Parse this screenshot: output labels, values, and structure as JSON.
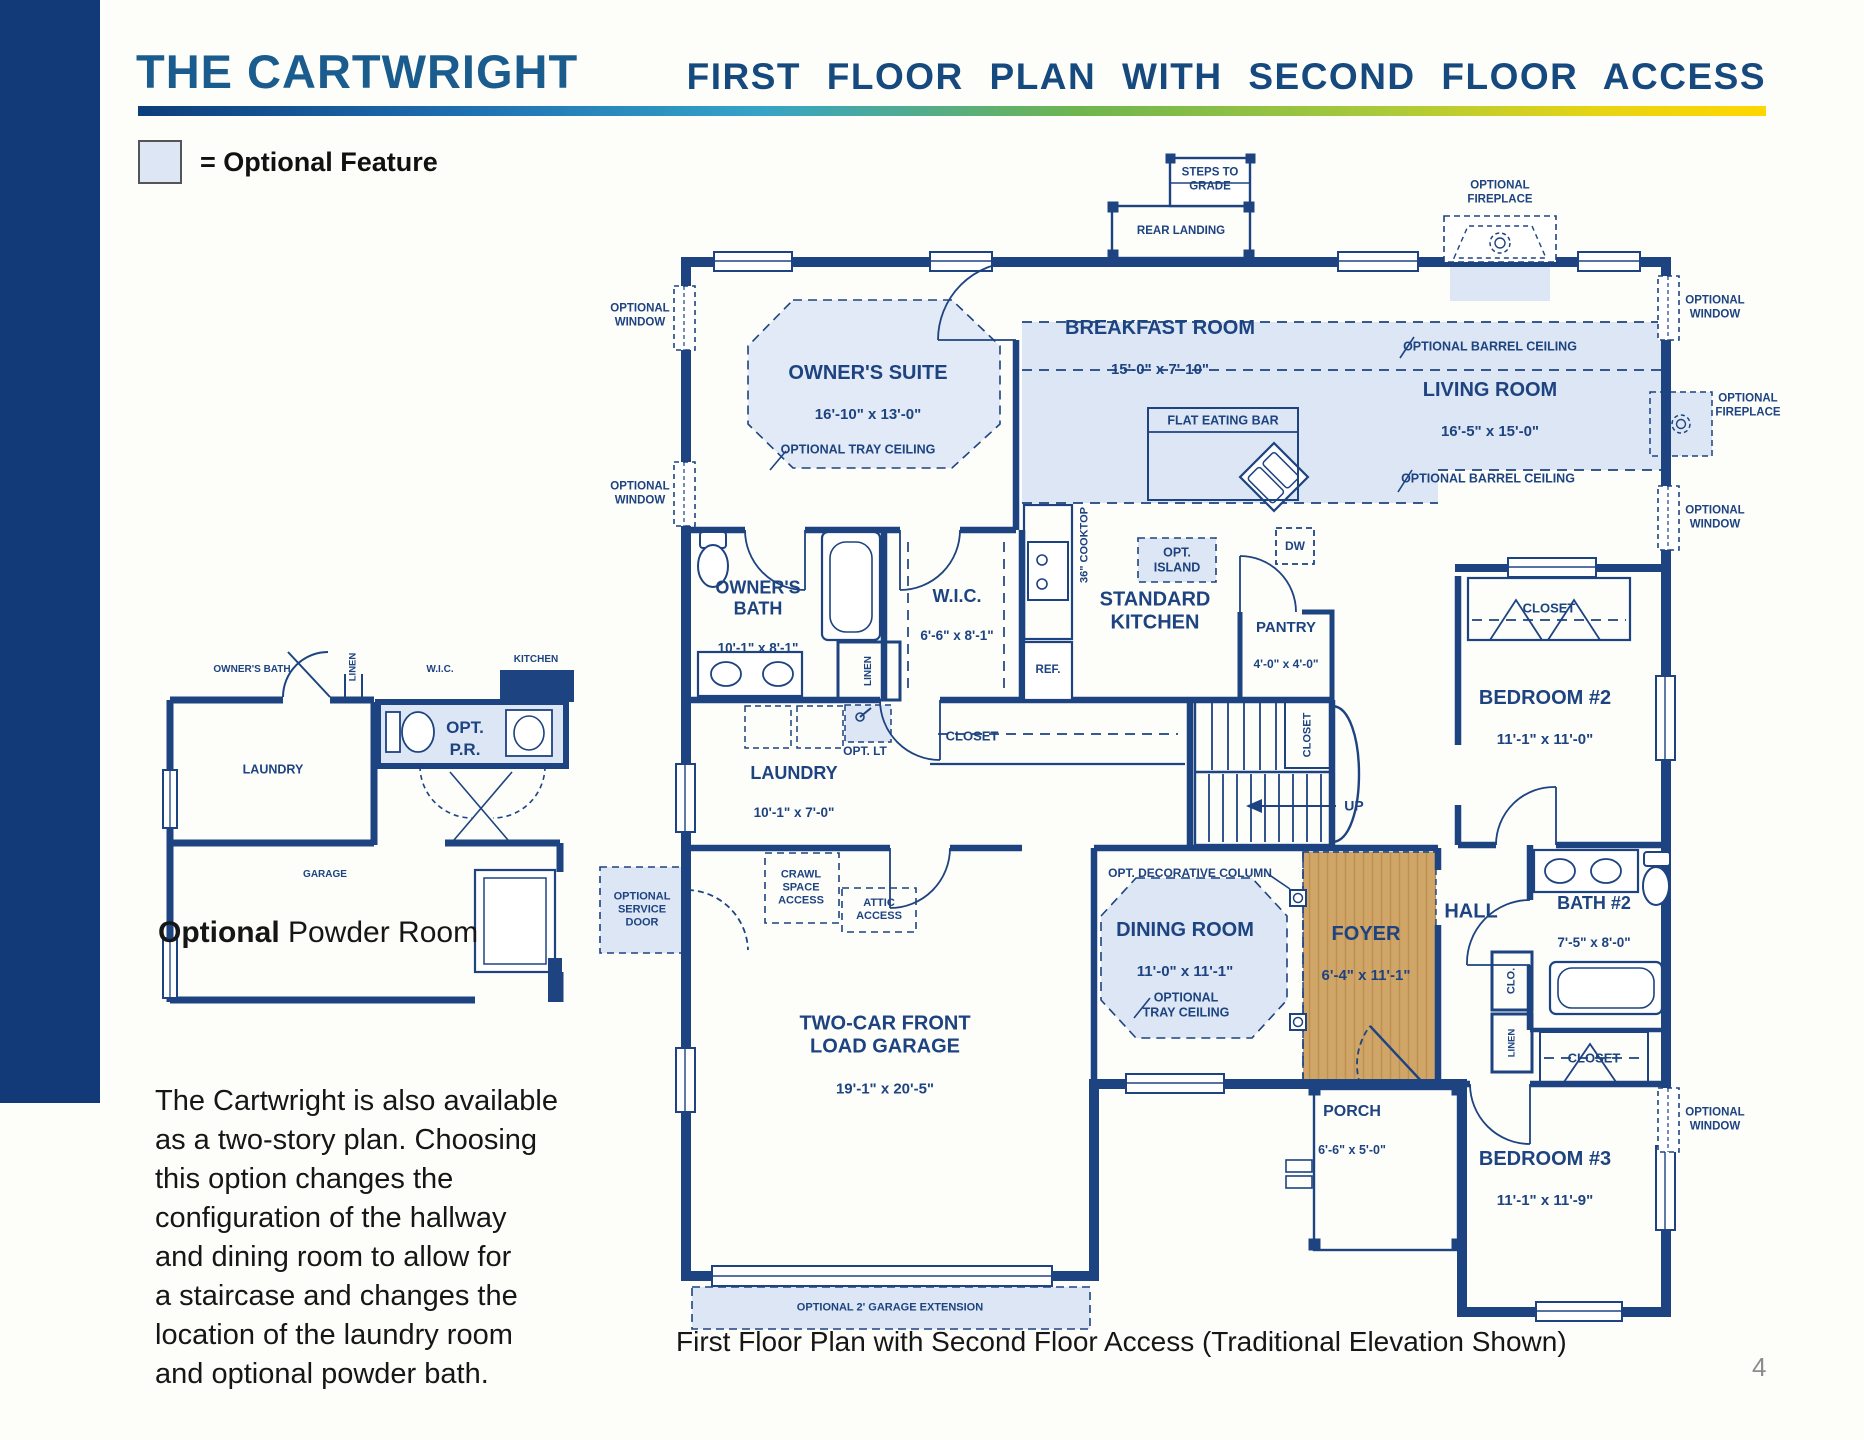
{
  "page": {
    "title": "THE CARTWRIGHT",
    "subtitle": "FIRST FLOOR PLAN WITH SECOND FLOOR ACCESS",
    "caption": "First Floor Plan with Second Floor Access (Traditional Elevation Shown)",
    "page_number": "4"
  },
  "legend": {
    "label": "= Optional Feature"
  },
  "note": {
    "text": "The Cartwright is also available\nas a two-story plan. Choosing\nthis option changes the\nconfiguration of the hallway\nand dining room to allow for\na staircase and changes the\nlocation of the laundry room\nand optional powder bath."
  },
  "inset": {
    "caption_bold": "Optional",
    "caption_rest": " Powder Room",
    "labels": {
      "owners_bath": "OWNER'S BATH",
      "linen": "LINEN",
      "wic": "W.I.C.",
      "kitchen": "KITCHEN",
      "opt": "OPT.",
      "pr": "P.R.",
      "laundry": "LAUNDRY",
      "garage": "GARAGE"
    }
  },
  "plan": {
    "rooms": {
      "owners_suite": {
        "name": "OWNER'S SUITE",
        "dim": "16'-10\" x 13'-0\""
      },
      "breakfast": {
        "name": "BREAKFAST ROOM",
        "dim": "15'-0\" x 7'-10\""
      },
      "living": {
        "name": "LIVING ROOM",
        "dim": "16'-5\" x 15'-0\""
      },
      "owners_bath": {
        "name": "OWNER'S\nBATH",
        "dim": "10'-1\" x 8'-1\""
      },
      "wic": {
        "name": "W.I.C.",
        "dim": "6'-6\" x 8'-1\""
      },
      "kitchen": {
        "name": "STANDARD\nKITCHEN"
      },
      "pantry": {
        "name": "PANTRY",
        "dim": "4'-0\" x 4'-0\""
      },
      "laundry": {
        "name": "LAUNDRY",
        "dim": "10'-1\" x 7'-0\""
      },
      "dining": {
        "name": "DINING ROOM",
        "dim": "11'-0\" x 11'-1\""
      },
      "foyer": {
        "name": "FOYER",
        "dim": "6'-4\" x 11'-1\""
      },
      "hall": {
        "name": "HALL"
      },
      "bath2": {
        "name": "BATH #2",
        "dim": "7'-5\" x 8'-0\""
      },
      "bedroom2": {
        "name": "BEDROOM #2",
        "dim": "11'-1\" x 11'-0\""
      },
      "bedroom3": {
        "name": "BEDROOM #3",
        "dim": "11'-1\" x 11'-9\""
      },
      "garage": {
        "name": "TWO-CAR FRONT\nLOAD GARAGE",
        "dim": "19'-1\" x 20'-5\""
      },
      "porch": {
        "name": "PORCH",
        "dim": "6'-6\" x 5'-0\""
      }
    },
    "annotations": {
      "steps_to_grade": "STEPS TO\nGRADE",
      "rear_landing": "REAR LANDING",
      "optional_fireplace": "OPTIONAL\nFIREPLACE",
      "optional_window": "OPTIONAL\nWINDOW",
      "optional_barrel_ceiling": "OPTIONAL BARREL CEILING",
      "optional_tray_ceiling": "OPTIONAL TRAY CEILING",
      "optional_tray_ceiling_2": "OPTIONAL\nTRAY CEILING",
      "flat_eating_bar": "FLAT EATING BAR",
      "cooktop": "36\" COOKTOP",
      "opt_island": "OPT.\nISLAND",
      "dw": "DW",
      "ref": "REF.",
      "linen": "LINEN",
      "closet": "CLOSET",
      "clo": "CLO.",
      "opt_lt": "OPT. LT",
      "up": "UP",
      "crawl_space": "CRAWL\nSPACE\nACCESS",
      "attic": "ATTIC\nACCESS",
      "service_door": "OPTIONAL\nSERVICE\nDOOR",
      "decorative_column": "OPT. DECORATIVE COLUMN",
      "garage_extension": "OPTIONAL 2' GARAGE EXTENSION"
    }
  },
  "colors": {
    "navy": "#1d4380",
    "optional_fill": "#dce6f4",
    "wood": "#d0a568",
    "title_left": "#1a5c8e",
    "title_right": "#16497e"
  }
}
